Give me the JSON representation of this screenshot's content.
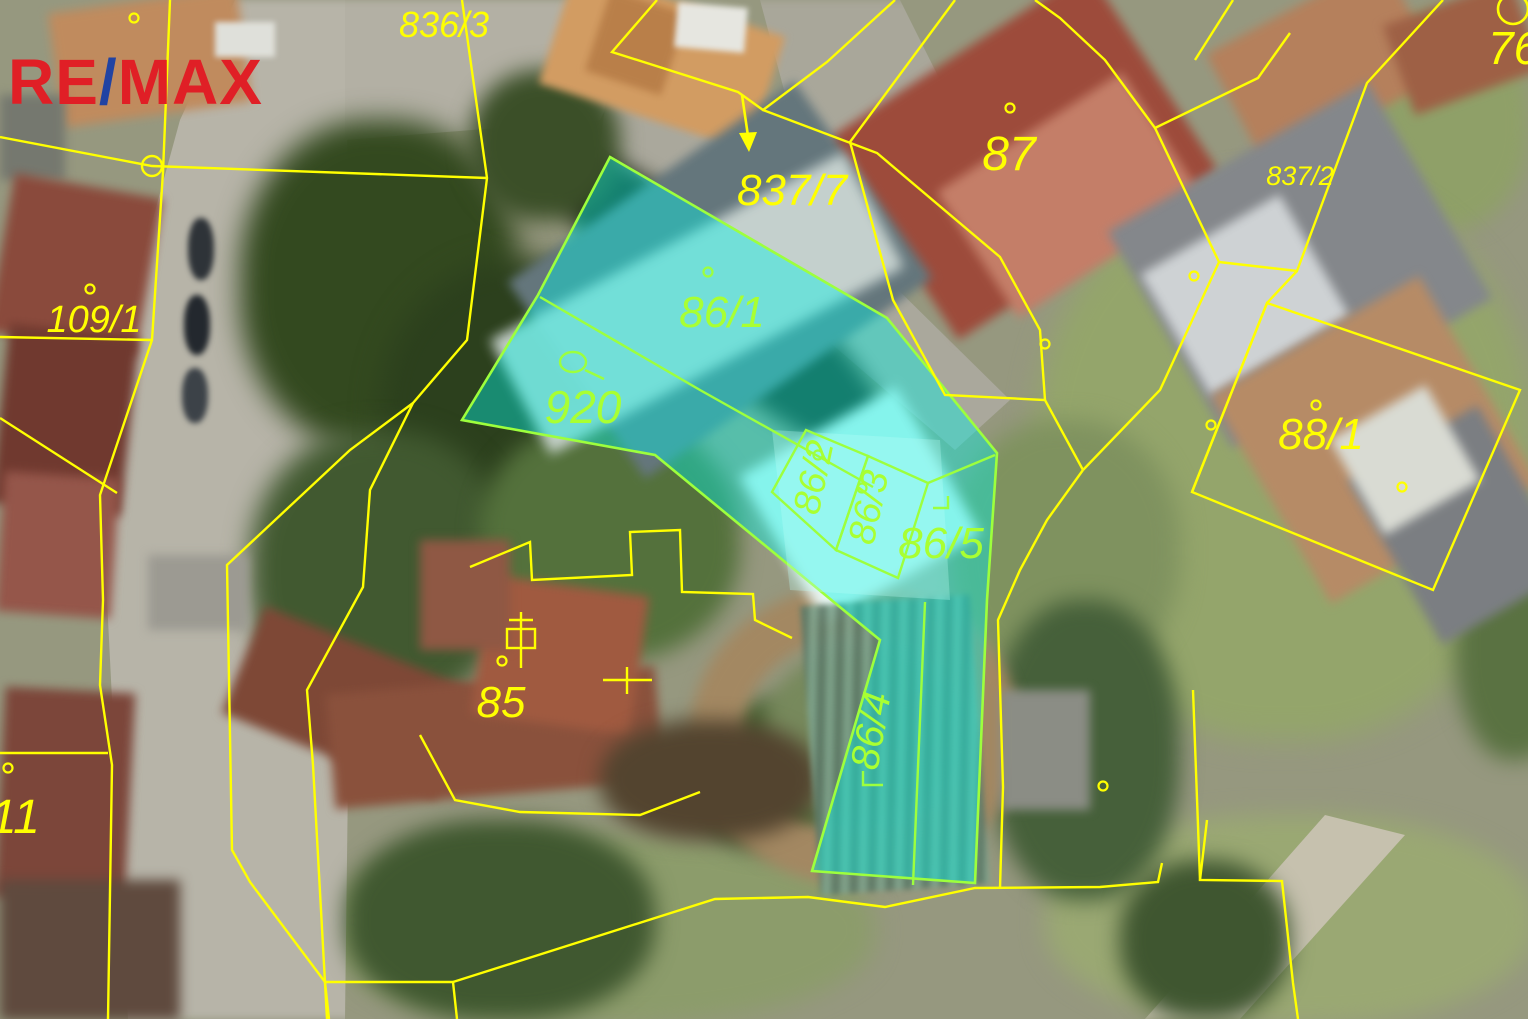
{
  "brand": {
    "name": "RE/MAX",
    "re": "RE",
    "slash": "/",
    "max": "MAX",
    "red": "#e01f26",
    "blue": "#2143a3"
  },
  "map": {
    "type": "cadastral-aerial-photo",
    "boundary_color": "#ffff00",
    "highlight_fill": "#00f2e6",
    "highlight_outline": "#9dff3d",
    "label_color_yellow": "#ffff00",
    "label_color_green": "#a9ff32",
    "highlighted_parcels": [
      "86/1",
      "920",
      "86/2",
      "86/3",
      "86/5",
      "86/4"
    ],
    "labels": [
      {
        "text": "836/3",
        "color": "yellow"
      },
      {
        "text": "761",
        "color": "yellow"
      },
      {
        "text": "837/7",
        "color": "yellow"
      },
      {
        "text": "87",
        "color": "yellow"
      },
      {
        "text": "837/2",
        "color": "yellow"
      },
      {
        "text": "109/1",
        "color": "yellow"
      },
      {
        "text": "11",
        "color": "yellow"
      },
      {
        "text": "85",
        "color": "yellow"
      },
      {
        "text": "88/1",
        "color": "yellow"
      },
      {
        "text": "86/1",
        "color": "green"
      },
      {
        "text": "920",
        "color": "green"
      },
      {
        "text": "86/5",
        "color": "green"
      },
      {
        "text": "86/2",
        "color": "green"
      },
      {
        "text": "86/3",
        "color": "green"
      },
      {
        "text": "86/4",
        "color": "green"
      }
    ]
  }
}
